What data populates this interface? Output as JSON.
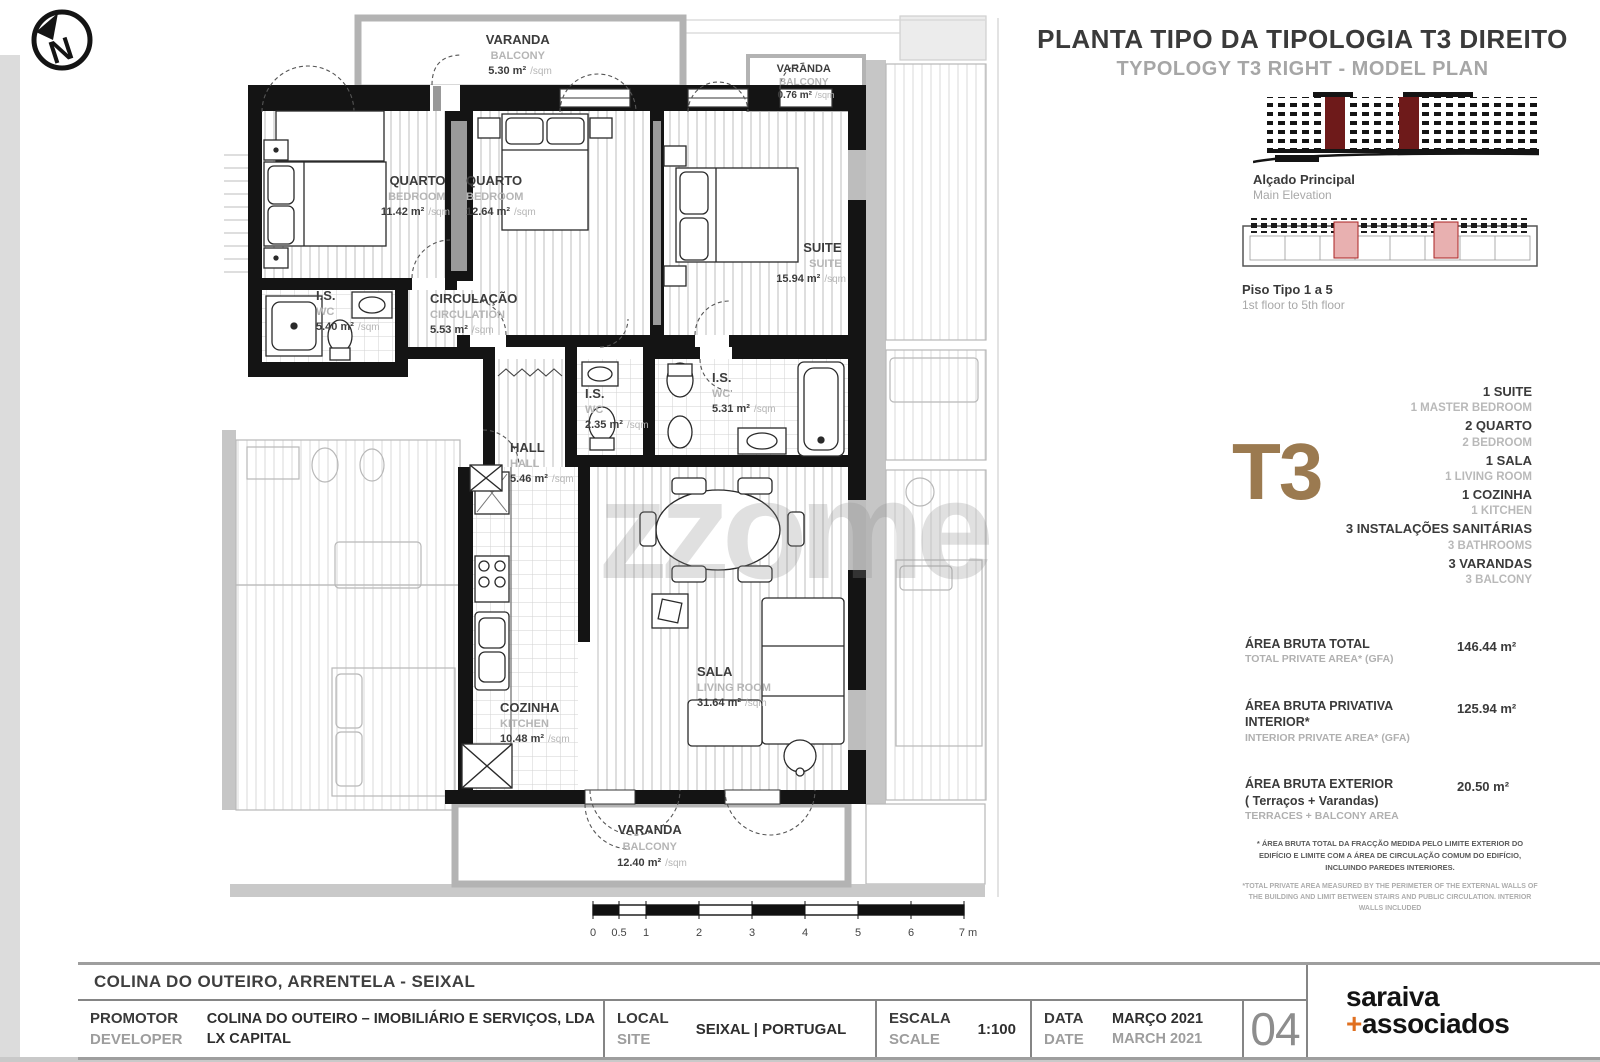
{
  "header": {
    "title_pt": "PLANTA TIPO DA TIPOLOGIA T3 DIREITO",
    "title_en": "TYPOLOGY T3 RIGHT - MODEL PLAN"
  },
  "figures": {
    "elevation_caption_pt": "Alçado Principal",
    "elevation_caption_en": "Main Elevation",
    "strip_caption_pt": "Piso Tipo 1 a 5",
    "strip_caption_en": "1st floor to 5th floor"
  },
  "typology": {
    "code": "T3",
    "accent_color": "#9b7a50",
    "program": [
      {
        "pt": "1 SUITE",
        "en": "1 MASTER BEDROOM"
      },
      {
        "pt": "2 QUARTO",
        "en": "2 BEDROOM"
      },
      {
        "pt": "1 SALA",
        "en": "1 LIVING ROOM"
      },
      {
        "pt": "1 COZINHA",
        "en": "1 KITCHEN"
      },
      {
        "pt": "3 INSTALAÇÕES SANITÁRIAS",
        "en": "3 BATHROOMS"
      },
      {
        "pt": "3 VARANDAS",
        "en": "3 BALCONY"
      }
    ]
  },
  "areas": {
    "items": [
      {
        "label_pt": "ÁREA BRUTA TOTAL",
        "label_pt2": "",
        "label_en": "TOTAL PRIVATE AREA* (GFA)",
        "value": "146.44 m²"
      },
      {
        "label_pt": "ÁREA BRUTA PRIVATIVA INTERIOR*",
        "label_pt2": "",
        "label_en": "INTERIOR PRIVATE AREA* (GFA)",
        "value": "125.94 m²"
      },
      {
        "label_pt": "ÁREA BRUTA EXTERIOR",
        "label_pt2": "( Terraços + Varandas)",
        "label_en": "TERRACES + BALCONY AREA",
        "value": "20.50 m²"
      }
    ],
    "footnote_pt": "* ÁREA BRUTA TOTAL DA FRACÇÃO MEDIDA PELO LIMITE EXTERIOR DO EDIFÍCIO E LIMITE COM A ÁREA DE CIRCULAÇÃO COMUM DO EDIFÍCIO, INCLUINDO PAREDES INTERIORES.",
    "footnote_en": "*TOTAL PRIVATE AREA MEASURED BY THE PERIMETER OF THE EXTERNAL WALLS OF THE BUILDING AND LIMIT BETWEEN STAIRS AND PUBLIC CIRCULATION. INTERIOR WALLS INCLUDED"
  },
  "plan": {
    "north_letter": "N",
    "watermark": "zzome",
    "unit_suffix": "/sqm",
    "rooms": [
      {
        "name_pt": "VARANDA",
        "name_en": "BALCONY",
        "area": "5.30 m²"
      },
      {
        "name_pt": "QUARTO",
        "name_en": "BEDROOM",
        "area": "11.42 m²"
      },
      {
        "name_pt": "QUARTO",
        "name_en": "BEDROOM",
        "area": "12.64 m²"
      },
      {
        "name_pt": "VARANDA",
        "name_en": "BALCONY",
        "area": "0.76 m²"
      },
      {
        "name_pt": "SUITE",
        "name_en": "SUITE",
        "area": "15.94 m²"
      },
      {
        "name_pt": "I.S.",
        "name_en": "WC",
        "area": "5.40 m²"
      },
      {
        "name_pt": "CIRCULAÇÃO",
        "name_en": "CIRCULATION",
        "area": "5.53 m²"
      },
      {
        "name_pt": "I.S.",
        "name_en": "WC",
        "area": "2.35 m²"
      },
      {
        "name_pt": "I.S.",
        "name_en": "WC",
        "area": "5.31 m²"
      },
      {
        "name_pt": "HALL",
        "name_en": "HALL",
        "area": "5.46 m²"
      },
      {
        "name_pt": "COZINHA",
        "name_en": "KITCHEN",
        "area": "10.48 m²"
      },
      {
        "name_pt": "SALA",
        "name_en": "LIVING ROOM",
        "area": "31.64 m²"
      },
      {
        "name_pt": "VARANDA",
        "name_en": "BALCONY",
        "area": "12.40 m²"
      }
    ],
    "scale_bar": {
      "labels": [
        "0",
        "0.5",
        "1",
        "2",
        "3",
        "4",
        "5",
        "6",
        "7 m"
      ]
    }
  },
  "titleblock": {
    "project": "COLINA DO OUTEIRO, ARRENTELA -  SEIXAL",
    "promotor_label_pt": "PROMOTOR",
    "promotor_label_en": "DEVELOPER",
    "promotor_value_1": "COLINA DO OUTEIRO – IMOBILIÁRIO E SERVIÇOS, LDA",
    "promotor_value_2": "LX CAPITAL",
    "local_label_pt": "LOCAL",
    "local_label_en": "SITE",
    "local_value": "SEIXAL | PORTUGAL",
    "escala_label_pt": "ESCALA",
    "escala_label_en": "SCALE",
    "escala_value": "1:100",
    "data_label_pt": "DATA",
    "data_label_en": "DATE",
    "data_value_pt": "MARÇO 2021",
    "data_value_en": "MARCH 2021",
    "sheet_number": "04",
    "logo_line1": "saraiva",
    "logo_plus": "+",
    "logo_line2": "associados"
  }
}
